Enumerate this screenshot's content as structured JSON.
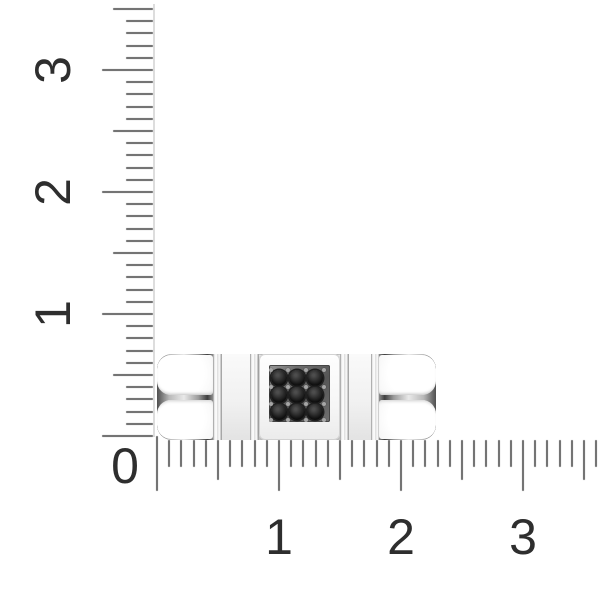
{
  "scene": {
    "background": "#ffffff"
  },
  "rulers": {
    "unit_px": 122,
    "minor_step": 0.1,
    "origin": {
      "x": 157,
      "y": 436
    },
    "colors": {
      "tick": "#747474",
      "line": "#dddddd",
      "label": "#2e2e2e"
    },
    "tick_lengths": {
      "minor": 27,
      "half": 40,
      "major": 51,
      "zero": 55
    },
    "vertical": {
      "line_x": 153,
      "line_top": 4,
      "max_value": 3.5,
      "label_center_x": 53,
      "labels": [
        {
          "text": "1",
          "value": 1
        },
        {
          "text": "2",
          "value": 2
        },
        {
          "text": "3",
          "value": 3
        }
      ]
    },
    "horizontal": {
      "tick_top": 440,
      "max_value": 3.6,
      "label_center_y": 537,
      "labels": [
        {
          "text": "1",
          "value": 1
        },
        {
          "text": "2",
          "value": 2
        },
        {
          "text": "3",
          "value": 3
        }
      ]
    },
    "zero": {
      "text": "0",
      "x": 125,
      "y": 466
    }
  },
  "ring": {
    "kind": "flat link-style band ring, side view, resting at ruler origin",
    "stone_grid": {
      "rows": 3,
      "cols": 3,
      "count": 9
    },
    "colors": {
      "stone": "#2a2a2a",
      "metal_light": "#ffffff",
      "metal_mid": "#ececec",
      "metal_edge": "#c5c5c5",
      "recess": "#5f5f5f"
    }
  }
}
